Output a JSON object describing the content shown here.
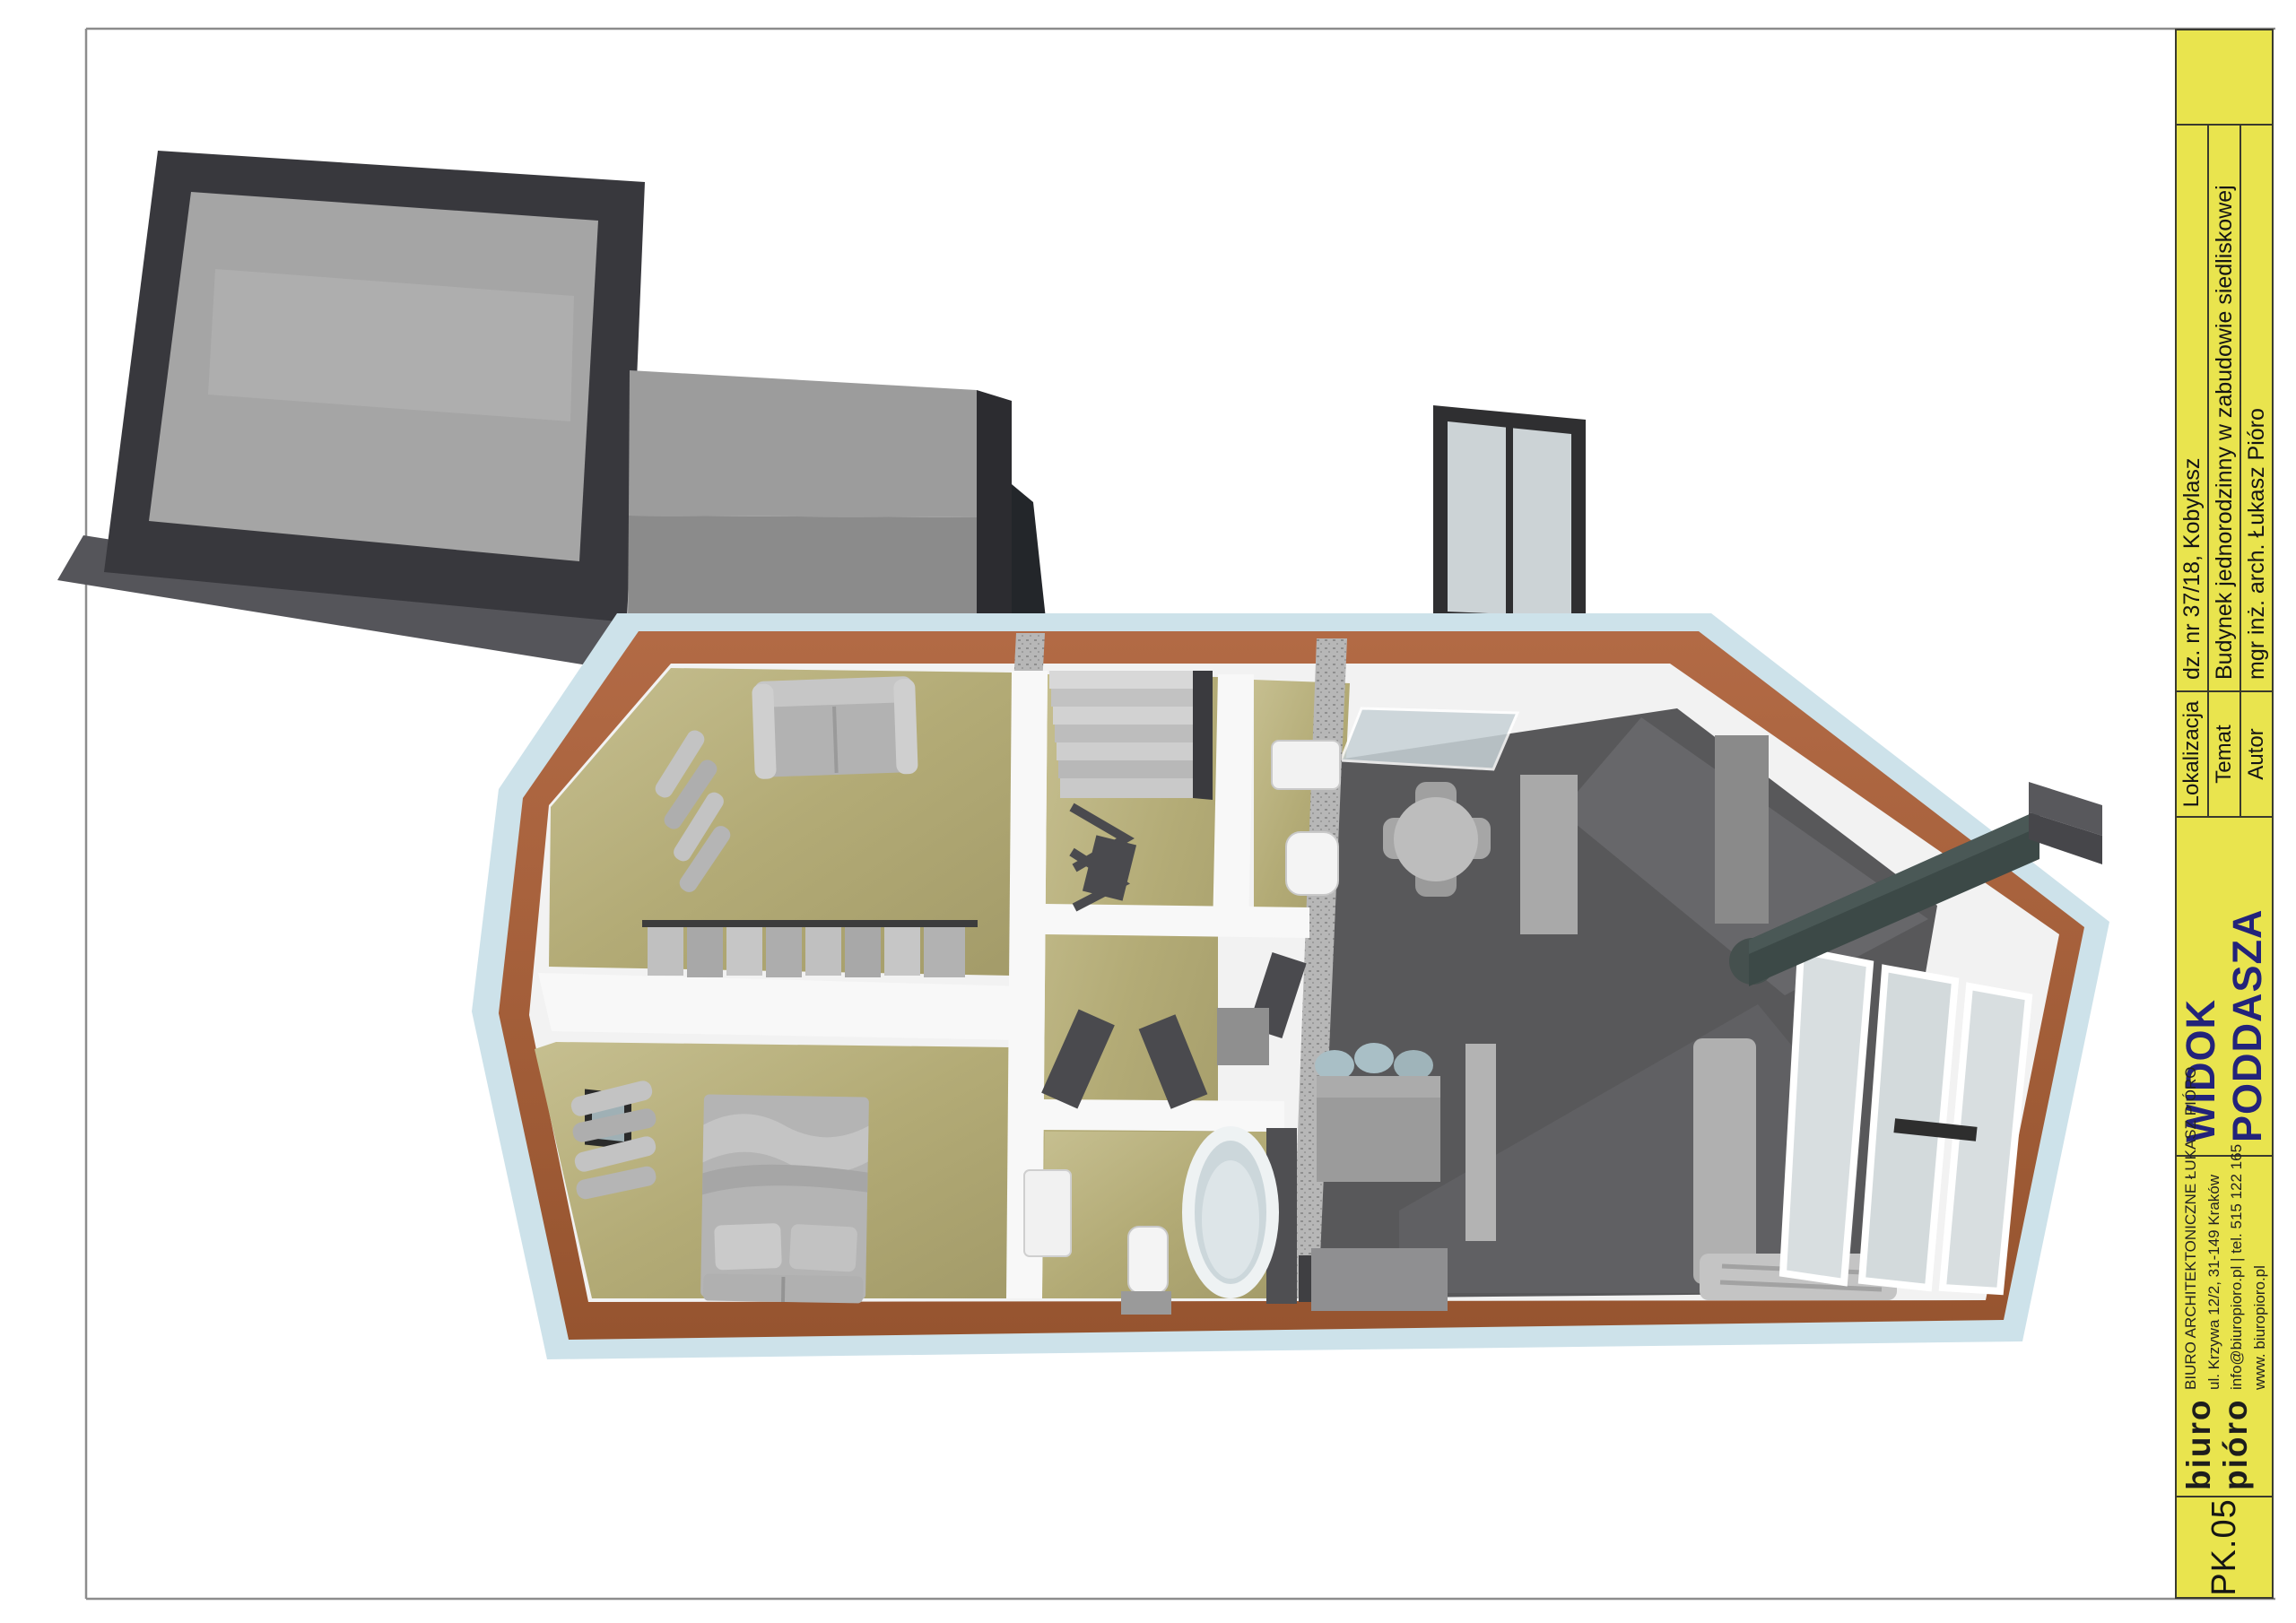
{
  "sheet": {
    "code": "PK.05",
    "view_title": "WIDOK PODDASZA",
    "fields": [
      {
        "label": "Lokalizacja",
        "value": "dz. nr 37/18, Kobylasz"
      },
      {
        "label": "Temat",
        "value": "Budynek jednorodzinny w zabudowie siedliskowej"
      },
      {
        "label": "Autor",
        "value": "mgr inż. arch. Łukasz  Pióro"
      }
    ],
    "office": {
      "logo_line1": "biuro",
      "logo_line2": "pióro",
      "name": "BIURO ARCHITEKTONICZNE ŁUKASZ PIÓRO",
      "address": "ul. Krzywa 12/2, 31-149 Kraków",
      "contact": "info@biuropioro.pl | tel. 515 122 165",
      "website": "www. biuropioro.pl"
    },
    "colors": {
      "title_block_bg": "#e9e44e",
      "title_block_border": "#3a3a2e",
      "view_title_color": "#23237a",
      "wall_cut": "#a9613c",
      "roof_edge_blue": "#cde2ea",
      "floor_wood": "#b3ab76",
      "floor_void": "#58585a",
      "roof_dark": "#38383d"
    }
  }
}
